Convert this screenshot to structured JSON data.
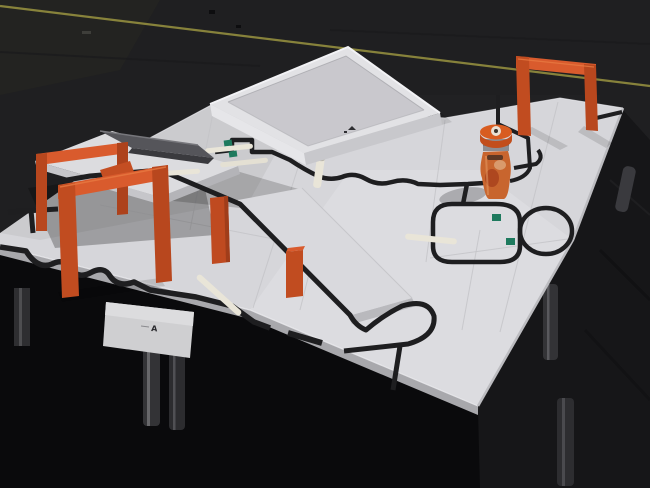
{
  "scene": {
    "description": "Robot line-following competition arena: white tables with black tape course, orange gates, evacuation tray, ramp and obstacles in a dark exhibition hall",
    "sign_mark": "A"
  },
  "colors": {
    "floor": "#1f1f21",
    "floor_dark": "#0a0a0c",
    "floor_right": "#161618",
    "tape_yellow": "#9a9440",
    "table_white": "#d6d6da",
    "table_edge": "#a8a8ac",
    "line_black": "#1e1e20",
    "gate_orange": "#d95b2d",
    "gate_orange_mid": "#c14c20",
    "gate_orange_dark": "#b8471e",
    "evac_wall": "#e2e2e5",
    "evac_floor": "#c9c8cd",
    "deck_white": "#dcdcdf",
    "ramp_white": "#d9d9dd",
    "marker_green": "#1e7a5e",
    "dowel_cream": "#e9e5d8",
    "leg_gray": "#333336",
    "wedge_gray": "#55555a",
    "jar_cap": "#d85c20",
    "jar_band": "#8e8e92",
    "jar_body": "#c8652e",
    "sign_paper": "#cfcfd1"
  }
}
